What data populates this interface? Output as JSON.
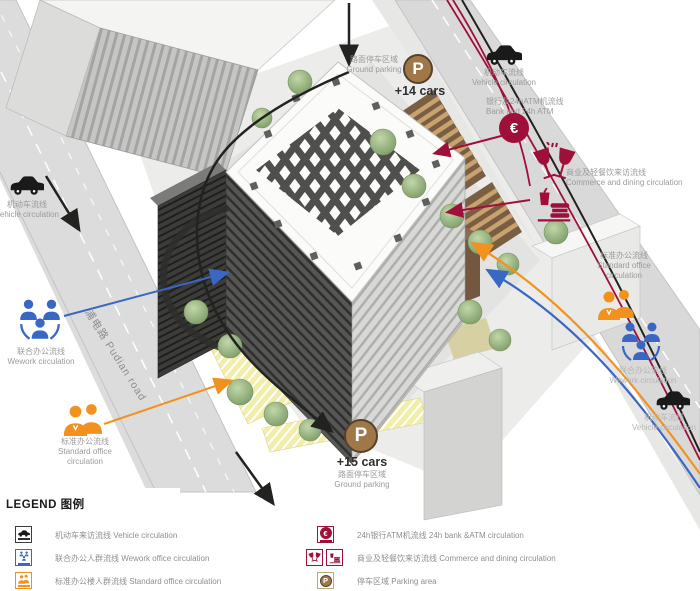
{
  "colors": {
    "crimson": "#9e1039",
    "blue": "#3a66c4",
    "orange": "#f2921e",
    "parking_brown": "#a07848",
    "road_gray": "#dcdcdc",
    "annotation_gray": "#9b9b9b"
  },
  "annotations": {
    "vehicle_top_left": {
      "zh": "机动车流线",
      "en": "Vehicle circulation"
    },
    "parking_top": {
      "zh": "路面停车区域",
      "en": "Ground parking",
      "symbol": "P",
      "count": "+14 cars"
    },
    "vehicle_top_right": {
      "zh": "机动车流线",
      "en": "Vehicle circulation"
    },
    "bank_atm": {
      "zh": "银行及24hATM机流线",
      "en": "Bank and 24h ATM",
      "symbol": "€"
    },
    "commerce_dining": {
      "zh": "商业及轻餐饮来访流线",
      "en": "Commerce and dining circulation"
    },
    "standard_office_right": {
      "zh": "标准办公流线",
      "en_line1": "Standard office",
      "en_line2": "circulation"
    },
    "wework_right": {
      "zh": "联合办公流线",
      "en": "Wework circulation"
    },
    "vehicle_bottom_right": {
      "zh": "机动车流线",
      "en": "Vehicle circulation"
    },
    "wework_left": {
      "zh": "联合办公流线",
      "en": "Wework circulation"
    },
    "standard_office_left": {
      "zh": "标准办公流线",
      "en_line1": "Standard office",
      "en_line2": "circulation"
    },
    "parking_bottom": {
      "zh": "路面停车区域",
      "en": "Ground parking",
      "symbol": "P",
      "count": "+15 cars"
    },
    "road_label": {
      "zh": "浦电路",
      "en": "Pudian road"
    }
  },
  "legend": {
    "title_en": "LEGEND",
    "title_zh": "图例",
    "left_items": [
      {
        "icon": "car-icon",
        "zh": "机动车来访流线",
        "en": "Vehicle circulation"
      },
      {
        "icon": "wework-people-icon",
        "zh": "联合办公人群流线",
        "en": "Wework office circulation"
      },
      {
        "icon": "office-people-icon",
        "zh": "标准办公楼人群流线",
        "en": "Standard office circulation"
      }
    ],
    "right_items": [
      {
        "icon": "euro-icon",
        "zh": "24h银行ATM机流线",
        "en": "24h bank &ATM circulation"
      },
      {
        "icon": "dining-icon",
        "zh": "商业及轻餐饮来访流线",
        "en": "Commerce and dining circulation"
      },
      {
        "icon": "parking-icon",
        "zh": "停车区域",
        "en": "Parking area",
        "symbol": "P"
      }
    ]
  }
}
